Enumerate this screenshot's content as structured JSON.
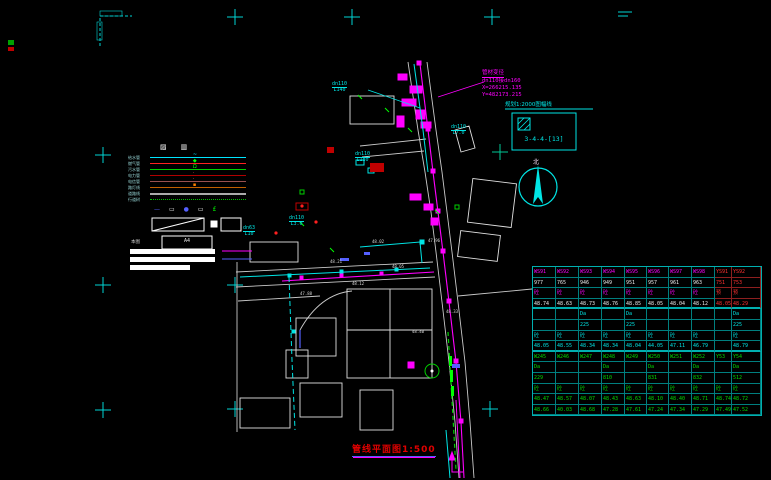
{
  "annotations": {
    "junction": {
      "title": "管材变径",
      "size": "dn110接dn160",
      "x_coord": "X=266215.135",
      "y_coord": "Y=482173.215"
    },
    "sheet_note": "规划1:2000图幅线",
    "sheet_no": "3-4-4-[13]",
    "north_label": "北",
    "title": "管线平面图1:500"
  },
  "map": {
    "pipe_labels": [
      {
        "x": 332,
        "y": 82,
        "dia": "dn110",
        "len": "L140"
      },
      {
        "x": 355,
        "y": 152,
        "dia": "dn110",
        "len": "L180"
      },
      {
        "x": 451,
        "y": 125,
        "dia": "dn110",
        "len": "L7.0"
      },
      {
        "x": 289,
        "y": 216,
        "dia": "dn110",
        "len": "L3.0"
      },
      {
        "x": 243,
        "y": 226,
        "dia": "dn63",
        "len": "L10"
      }
    ],
    "spot_elevations": [
      {
        "x": 352,
        "y": 281,
        "v": "48.12"
      },
      {
        "x": 392,
        "y": 264,
        "v": "48.05"
      },
      {
        "x": 428,
        "y": 238,
        "v": "47.96"
      },
      {
        "x": 446,
        "y": 309,
        "v": "48.33"
      },
      {
        "x": 330,
        "y": 259,
        "v": "48.21"
      },
      {
        "x": 300,
        "y": 291,
        "v": "47.88"
      },
      {
        "x": 412,
        "y": 329,
        "v": "48.40"
      },
      {
        "x": 372,
        "y": 239,
        "v": "48.02"
      }
    ]
  },
  "legend": {
    "header_glyphs": [
      "▨",
      "▥"
    ],
    "rows": [
      {
        "name": "给水管",
        "color": "#00e5ff",
        "style": "solid",
        "mid": "~",
        "midc": "#00e5ff"
      },
      {
        "name": "燃气管",
        "color": "#ff2020",
        "style": "solid",
        "mid": "◆",
        "midc": "#00ff00"
      },
      {
        "name": "污水管",
        "color": "#00d000",
        "style": "solid",
        "mid": "Ω",
        "midc": "#00ff00"
      },
      {
        "name": "电力管",
        "color": "#b00000",
        "style": "solid",
        "mid": "·",
        "midc": "#ff6060"
      },
      {
        "name": "电信管",
        "color": "#985050",
        "style": "solid",
        "mid": "·",
        "midc": "#ff8080"
      },
      {
        "name": "路灯线",
        "color": "#c06000",
        "style": "solid",
        "mid": "▪",
        "midc": "#ff8000"
      },
      {
        "name": "道路线",
        "color": "#aaaaaa",
        "style": "solid",
        "thick": true
      },
      {
        "name": "行道树",
        "color": "#00c000",
        "style": "dotted"
      }
    ],
    "symbol_glyphs": [
      {
        "ch": "—",
        "c": "#5560ff"
      },
      {
        "ch": "▭",
        "c": "#ffffff"
      },
      {
        "ch": "●",
        "c": "#5560ff"
      },
      {
        "ch": "▭",
        "c": "#ffffff"
      },
      {
        "ch": "£",
        "c": "#00ff00"
      }
    ],
    "note1": "本图",
    "a4_label": "A4"
  },
  "table": {
    "col_widths": [
      23,
      23,
      23,
      23,
      22,
      22,
      23,
      23,
      17,
      29
    ],
    "rows": [
      {
        "c": "m",
        "cells": [
          "WS91",
          "WS92",
          "WS93",
          "WS94",
          "WS95",
          "WS96",
          "WS97",
          "WS98",
          "YS91",
          "YS92"
        ]
      },
      {
        "c": "w",
        "cells": [
          "977",
          "765",
          "946",
          "949",
          "951",
          "957",
          "961",
          "963",
          "751",
          "753"
        ]
      },
      {
        "c": "m",
        "cells": [
          "砼",
          "砼",
          "砼",
          "砼",
          "砼",
          "砼",
          "砼",
          "砼",
          "预",
          "预"
        ]
      },
      {
        "c": "w",
        "cells": [
          "48.74",
          "48.63",
          "48.73",
          "48.76",
          "48.85",
          "48.05",
          "48.04",
          "48.12",
          "48.05",
          "48.29"
        ]
      },
      {
        "c": "c",
        "cells": [
          "",
          "",
          "Da",
          "",
          "Da",
          "",
          "",
          "",
          "",
          "Da"
        ]
      },
      {
        "c": "c",
        "cells": [
          "",
          "",
          "225",
          "",
          "225",
          "",
          "",
          "",
          "",
          "225"
        ]
      },
      {
        "c": "c",
        "cells": [
          "砼",
          "砼",
          "砼",
          "砼",
          "砼",
          "砼",
          "砼",
          "砼",
          "",
          "砼"
        ]
      },
      {
        "c": "c",
        "cells": [
          "48.05",
          "48.55",
          "48.34",
          "48.34",
          "48.04",
          "44.05",
          "47.11",
          "46.79",
          "",
          "48.79"
        ]
      },
      {
        "c": "g",
        "cells": [
          "W245",
          "W246",
          "W247",
          "W248",
          "W249",
          "W250",
          "W251",
          "W252",
          "Y53",
          "Y54"
        ]
      },
      {
        "c": "g",
        "cells": [
          "Da",
          "",
          "",
          "Da",
          "",
          "Da",
          "",
          "Da",
          "",
          "Da"
        ]
      },
      {
        "c": "g",
        "cells": [
          "229",
          "",
          "",
          "810",
          "",
          "831",
          "",
          "832",
          "",
          "512"
        ]
      },
      {
        "c": "g",
        "cells": [
          "砼",
          "砼",
          "砼",
          "砼",
          "砼",
          "砼",
          "砼",
          "砼",
          "砼",
          "砼"
        ]
      },
      {
        "c": "g",
        "cells": [
          "48.47",
          "48.57",
          "48.07",
          "48.43",
          "48.63",
          "48.10",
          "48.40",
          "48.71",
          "48.74",
          "48.72"
        ]
      },
      {
        "c": "g",
        "cells": [
          "48.66",
          "40.03",
          "48.68",
          "47.28",
          "47.61",
          "47.24",
          "47.34",
          "47.29",
          "47.49",
          "47.52"
        ]
      }
    ]
  }
}
